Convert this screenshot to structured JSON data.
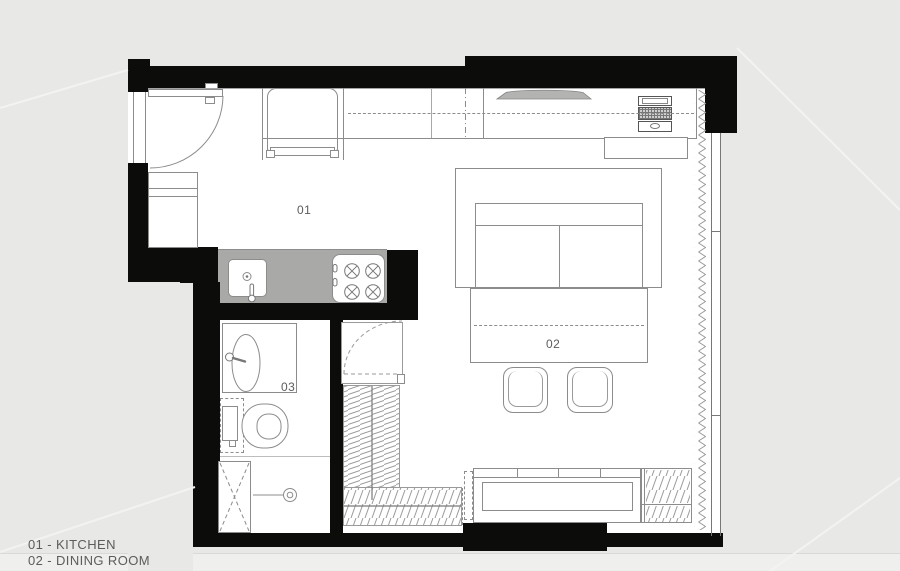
{
  "canvas": {
    "width": 900,
    "height": 571
  },
  "rooms": [
    {
      "id": "kitchen",
      "number": "01"
    },
    {
      "id": "dining-room",
      "number": "02"
    },
    {
      "id": "bathroom",
      "number": "03"
    }
  ],
  "legend": {
    "items": [
      "01 - KITCHEN",
      "02 - DINING ROOM"
    ]
  },
  "colors": {
    "exterior": "#e8e8e7",
    "exterior_light": "#efefee",
    "floor": "#ffffff",
    "wall": "#0c0c0b",
    "counter": "#a9a9a8",
    "line": "#8c8c8c",
    "line_dark": "#555555",
    "line_light": "#bdbdbd",
    "shelf": "#b3b3b2",
    "text": "#5c5c5c"
  }
}
